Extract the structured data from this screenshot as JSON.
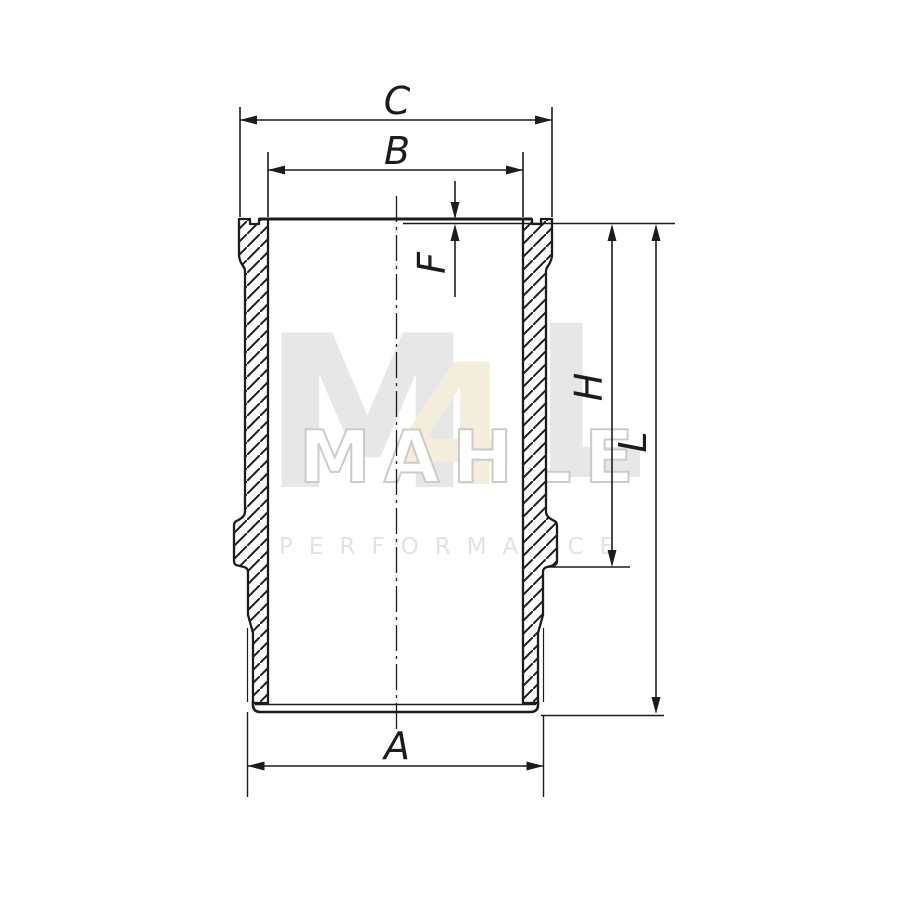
{
  "diagram": {
    "dimensions": {
      "C": {
        "label": "C"
      },
      "B": {
        "label": "B"
      },
      "F": {
        "label": "F"
      },
      "H": {
        "label": "H"
      },
      "L": {
        "label": "L"
      },
      "A": {
        "label": "A"
      }
    },
    "colors": {
      "line": "#1c1c1c",
      "background": "#ffffff"
    }
  },
  "watermark": {
    "logo_m": "M",
    "logo_4": "4",
    "logo_l": "L",
    "logo_text": "MAHLE",
    "subtitle": "PERFORMANCE",
    "colors": {
      "gray": "#e7e7e7",
      "cream": "#f3eedb",
      "outline_stroke": "#cbcbcb"
    }
  }
}
